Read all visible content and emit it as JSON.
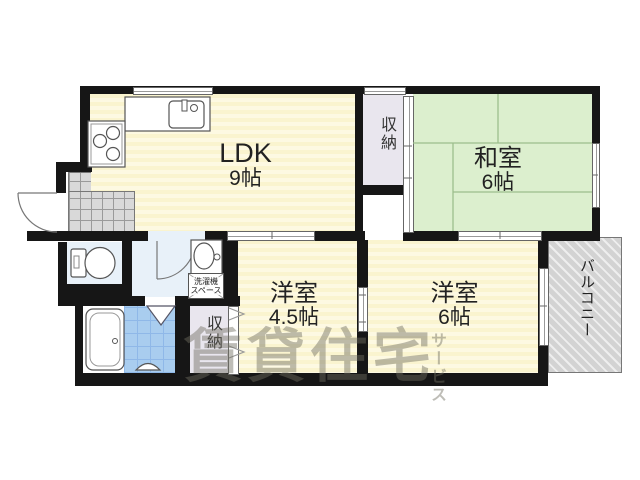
{
  "plan": {
    "rooms": {
      "ldk": {
        "name": "LDK",
        "size": "9帖"
      },
      "washitsu": {
        "name": "和室",
        "size": "6帖"
      },
      "bedroom_small": {
        "name": "洋室",
        "size": "4.5帖"
      },
      "bedroom_large": {
        "name": "洋室",
        "size": "6帖"
      }
    },
    "labels": {
      "storage_upper": "収納",
      "storage_lower": "収納",
      "balcony": "バルコニー",
      "laundry_line1": "洗濯機",
      "laundry_line2": "スペース"
    },
    "watermark": {
      "main": "賃貸住宅",
      "sub": "サービス"
    },
    "colors": {
      "wall": "#161616",
      "room_yellow": "#FAF4CF",
      "room_yellow2": "#FDF9E2",
      "tatami": "#DCEFCE",
      "tatami_line": "#9DBE8D",
      "tile_blue": "#A9CDEF",
      "tile_line": "#8FB8E8",
      "floor_blue": "#E8F1F9",
      "storage": "#E9E6EE",
      "balcony": "#D8D8D8",
      "entrance_tile": "#D9D9D9",
      "watermark": "rgba(110,108,95,0.45)",
      "label": "#222222"
    }
  }
}
